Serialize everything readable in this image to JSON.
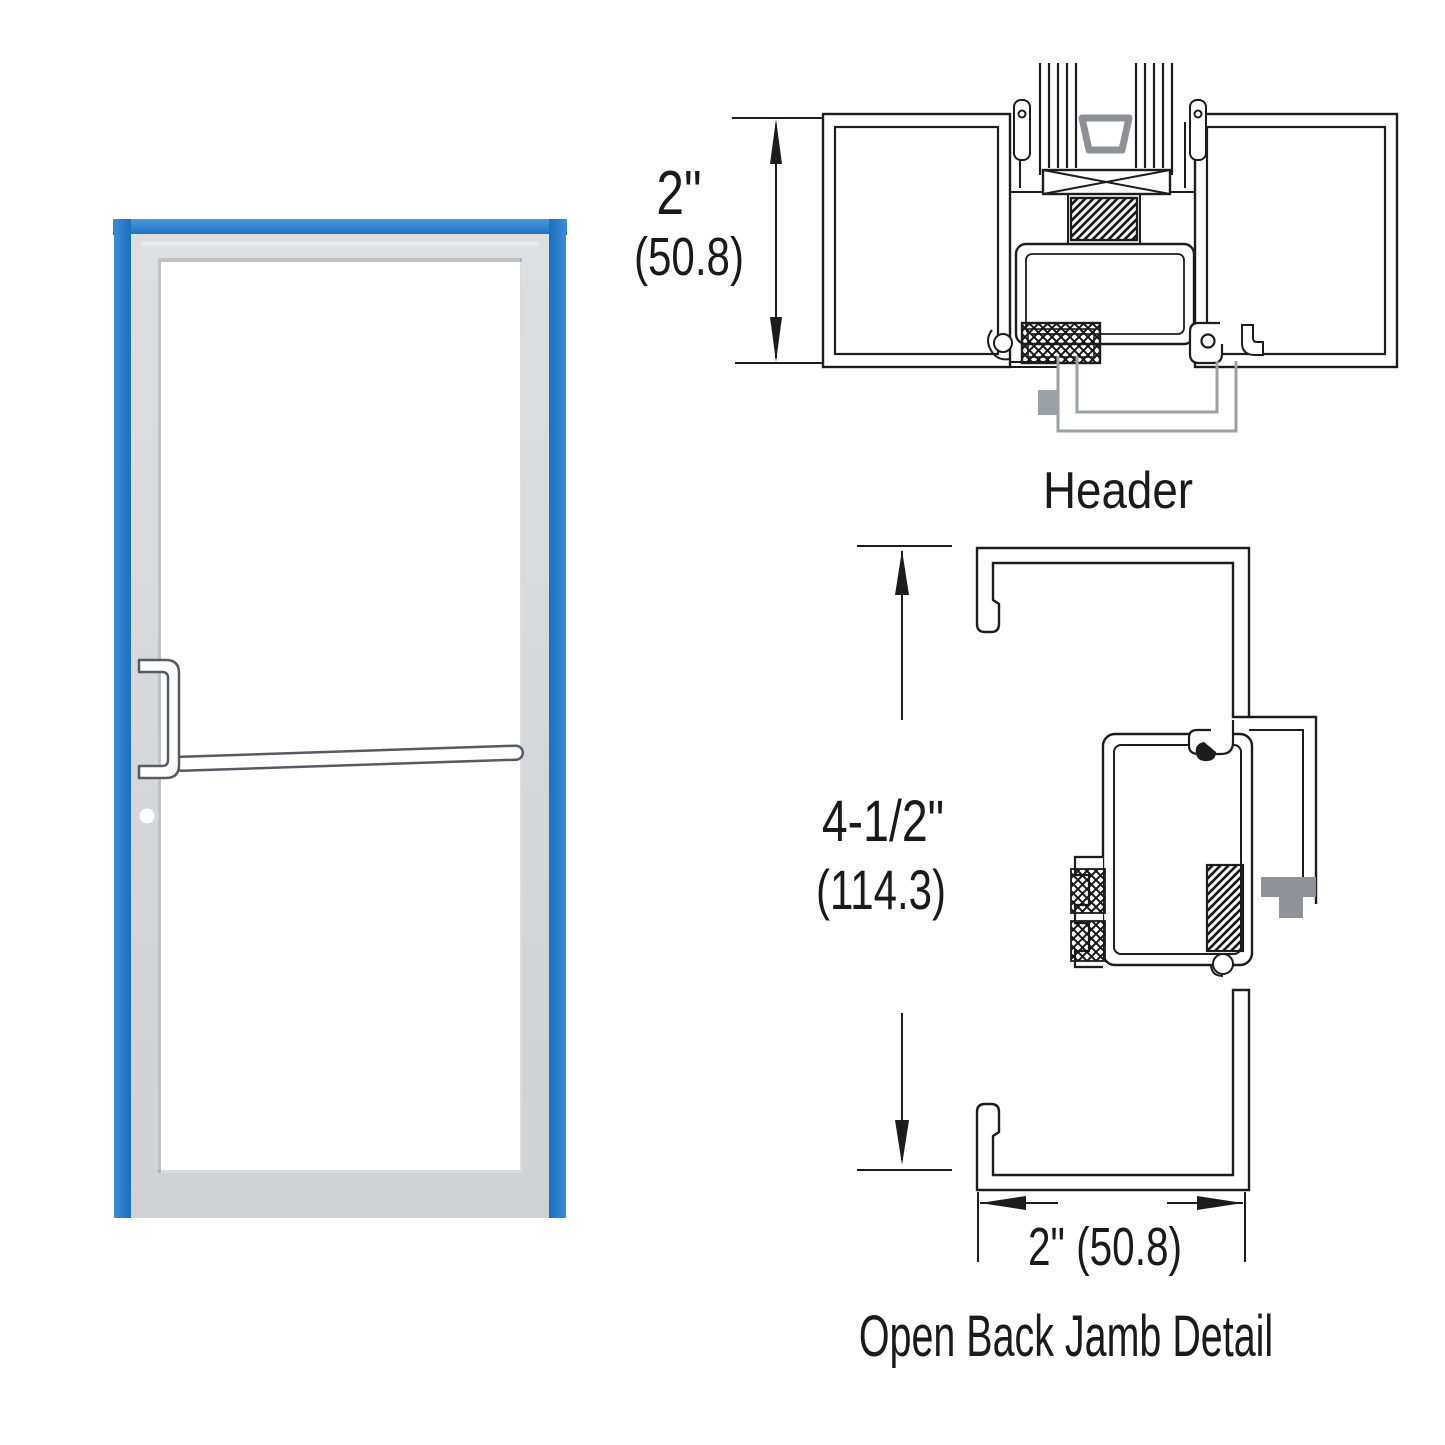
{
  "illustration": {
    "name": "aluminum storefront door with blue open-back frame",
    "frame_color_blue": "#1e76c8",
    "door_color_gray": "#d6d8da",
    "hardware": [
      "offset pull handle",
      "push bar",
      "cylinder lock dot"
    ]
  },
  "header_detail": {
    "label": "Header",
    "dimension": {
      "inches": "2\"",
      "millimeters": "(50.8)"
    }
  },
  "jamb_detail": {
    "label": "Open Back Jamb Detail",
    "height_dimension": {
      "inches": "4-1/2\"",
      "millimeters": "(114.3)"
    },
    "width_dimension": {
      "text": "2\" (50.8)"
    }
  },
  "line_color": "#1c1c1c"
}
